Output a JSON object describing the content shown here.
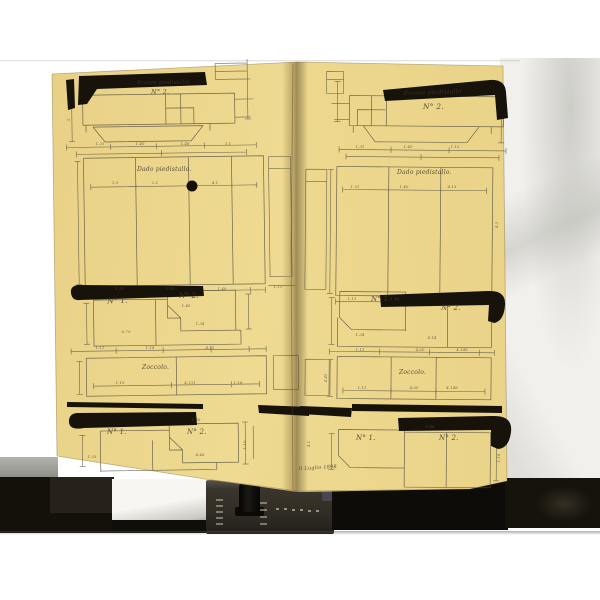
{
  "colors": {
    "background": "#ffffff",
    "backdrop_paper": "#f1f0ec",
    "document_paper": "#ead489",
    "drawing_ink": "#57503f",
    "heavy_ink": "#17130b",
    "device_body": "#33302a"
  },
  "left_page": {
    "top_title": "Fronte piedistallo",
    "top_number": "N° 2.",
    "dado_label": "Dado piedistallo.",
    "mid_left_label": "N° 1.",
    "mid_right_label": "N° 2.",
    "zoccolo_label": "Zoccolo.",
    "bottom_left_label": "N° 1.",
    "bottom_right_label": "N° 2."
  },
  "right_page": {
    "top_title": "Fronte piedistallo",
    "top_number": "N° 2.",
    "dado_label": "Dado piedistallo.",
    "mid_left_label": "N° 1.",
    "mid_right_label": "N° 2.",
    "zoccolo_label": "Zoccolo.",
    "bottom_left_label": "N° 1.",
    "bottom_right_label": "N° 2.",
    "footer_note": "li Luglio 1898"
  },
  "dimensions": [
    {
      "x": 100,
      "y": 145,
      "t": "1.31"
    },
    {
      "x": 140,
      "y": 145,
      "t": "1.40"
    },
    {
      "x": 185,
      "y": 145,
      "t": "1.48"
    },
    {
      "x": 228,
      "y": 145,
      "t": "1.1"
    },
    {
      "x": 70,
      "y": 120,
      "t": "5",
      "r": -90
    },
    {
      "x": 115,
      "y": 184,
      "t": "1.9"
    },
    {
      "x": 155,
      "y": 184,
      "t": "2.1"
    },
    {
      "x": 215,
      "y": 184,
      "t": "4.1"
    },
    {
      "x": 120,
      "y": 290,
      "t": "1.31"
    },
    {
      "x": 170,
      "y": 290,
      "t": "1.10"
    },
    {
      "x": 222,
      "y": 290,
      "t": "1.40"
    },
    {
      "x": 186,
      "y": 307,
      "t": "1.40"
    },
    {
      "x": 126,
      "y": 333,
      "t": "6.79"
    },
    {
      "x": 200,
      "y": 325,
      "t": "1.34"
    },
    {
      "x": 100,
      "y": 349,
      "t": "1.11"
    },
    {
      "x": 150,
      "y": 349,
      "t": "1.14"
    },
    {
      "x": 210,
      "y": 349,
      "t": "4.11"
    },
    {
      "x": 120,
      "y": 384,
      "t": "1.19"
    },
    {
      "x": 190,
      "y": 384,
      "t": "4.131"
    },
    {
      "x": 238,
      "y": 384,
      "t": "1.18"
    },
    {
      "x": 278,
      "y": 288,
      "t": "1.11"
    },
    {
      "x": 196,
      "y": 421,
      "t": "1.46"
    },
    {
      "x": 200,
      "y": 456,
      "t": "4.46"
    },
    {
      "x": 92,
      "y": 458,
      "t": "1.33"
    },
    {
      "x": 246,
      "y": 445,
      "t": "1.10",
      "r": -90
    },
    {
      "x": 360,
      "y": 148,
      "t": "1.31"
    },
    {
      "x": 408,
      "y": 148,
      "t": "1.40"
    },
    {
      "x": 455,
      "y": 148,
      "t": "1.13"
    },
    {
      "x": 355,
      "y": 188,
      "t": "1.31"
    },
    {
      "x": 404,
      "y": 188,
      "t": "1.40"
    },
    {
      "x": 452,
      "y": 188,
      "t": "4.13"
    },
    {
      "x": 352,
      "y": 300,
      "t": "1.11"
    },
    {
      "x": 395,
      "y": 300,
      "t": "1.10"
    },
    {
      "x": 498,
      "y": 225,
      "t": "4.5",
      "r": -90
    },
    {
      "x": 360,
      "y": 336,
      "t": "1.34"
    },
    {
      "x": 432,
      "y": 339,
      "t": "4.14"
    },
    {
      "x": 360,
      "y": 351,
      "t": "1.11"
    },
    {
      "x": 420,
      "y": 351,
      "t": "4.00"
    },
    {
      "x": 462,
      "y": 351,
      "t": "4.148"
    },
    {
      "x": 362,
      "y": 389,
      "t": "1.11"
    },
    {
      "x": 414,
      "y": 389,
      "t": "4.00"
    },
    {
      "x": 452,
      "y": 389,
      "t": "4.148"
    },
    {
      "x": 327,
      "y": 378,
      "t": "4.41",
      "r": -90
    },
    {
      "x": 430,
      "y": 428,
      "t": "1.46"
    },
    {
      "x": 500,
      "y": 458,
      "t": "1.18",
      "r": -90
    },
    {
      "x": 310,
      "y": 444,
      "t": "4.1",
      "r": -90
    }
  ]
}
